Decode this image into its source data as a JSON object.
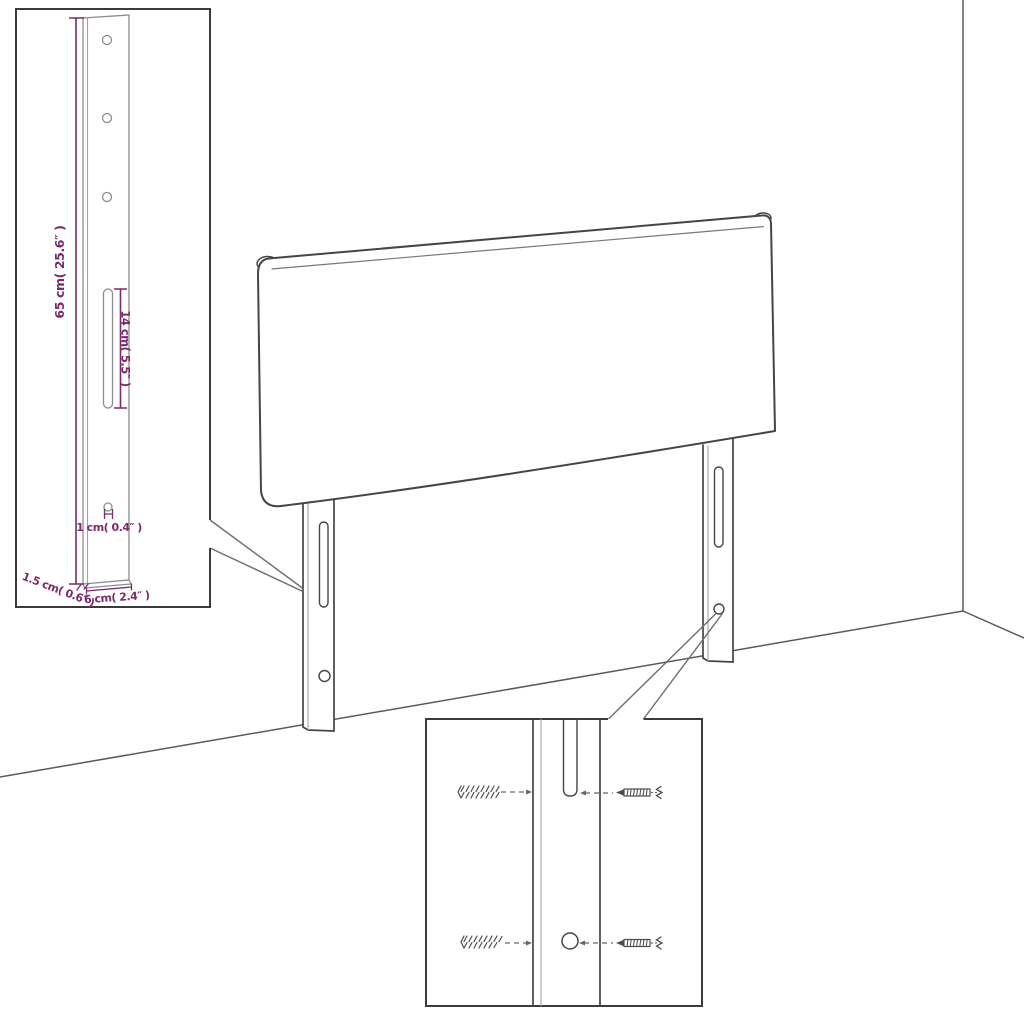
{
  "diagram": {
    "kind": "product-dimension-diagram",
    "subject": "headboard with two mounting legs, wall corner and floor shown in perspective",
    "background": "#ffffff",
    "colors": {
      "outline": "#454545",
      "light_line": "#a3a3a3",
      "box_border": "#3b3b3b",
      "dimension_accent": "#7b2a6b"
    },
    "leg_detail_callout": {
      "description": "magnified front view of one mounting leg with three holes, one slot and one small hole",
      "hole_count_top": 3,
      "dims": {
        "height": "65 cm( 25.6″ )",
        "slot_length": "14 cm( 5.5″ )",
        "hole_diameter": "1 cm( 0.4″ )",
        "thickness": "1.5 cm( 0.6″ )",
        "width": "6 cm( 2.4″ )"
      }
    },
    "hardware_detail_callout": {
      "description": "magnified view of leg slot and hole with two wall plugs and two screws",
      "icons": [
        "wall-plug-icon",
        "screw-icon"
      ],
      "rows": 2
    }
  }
}
